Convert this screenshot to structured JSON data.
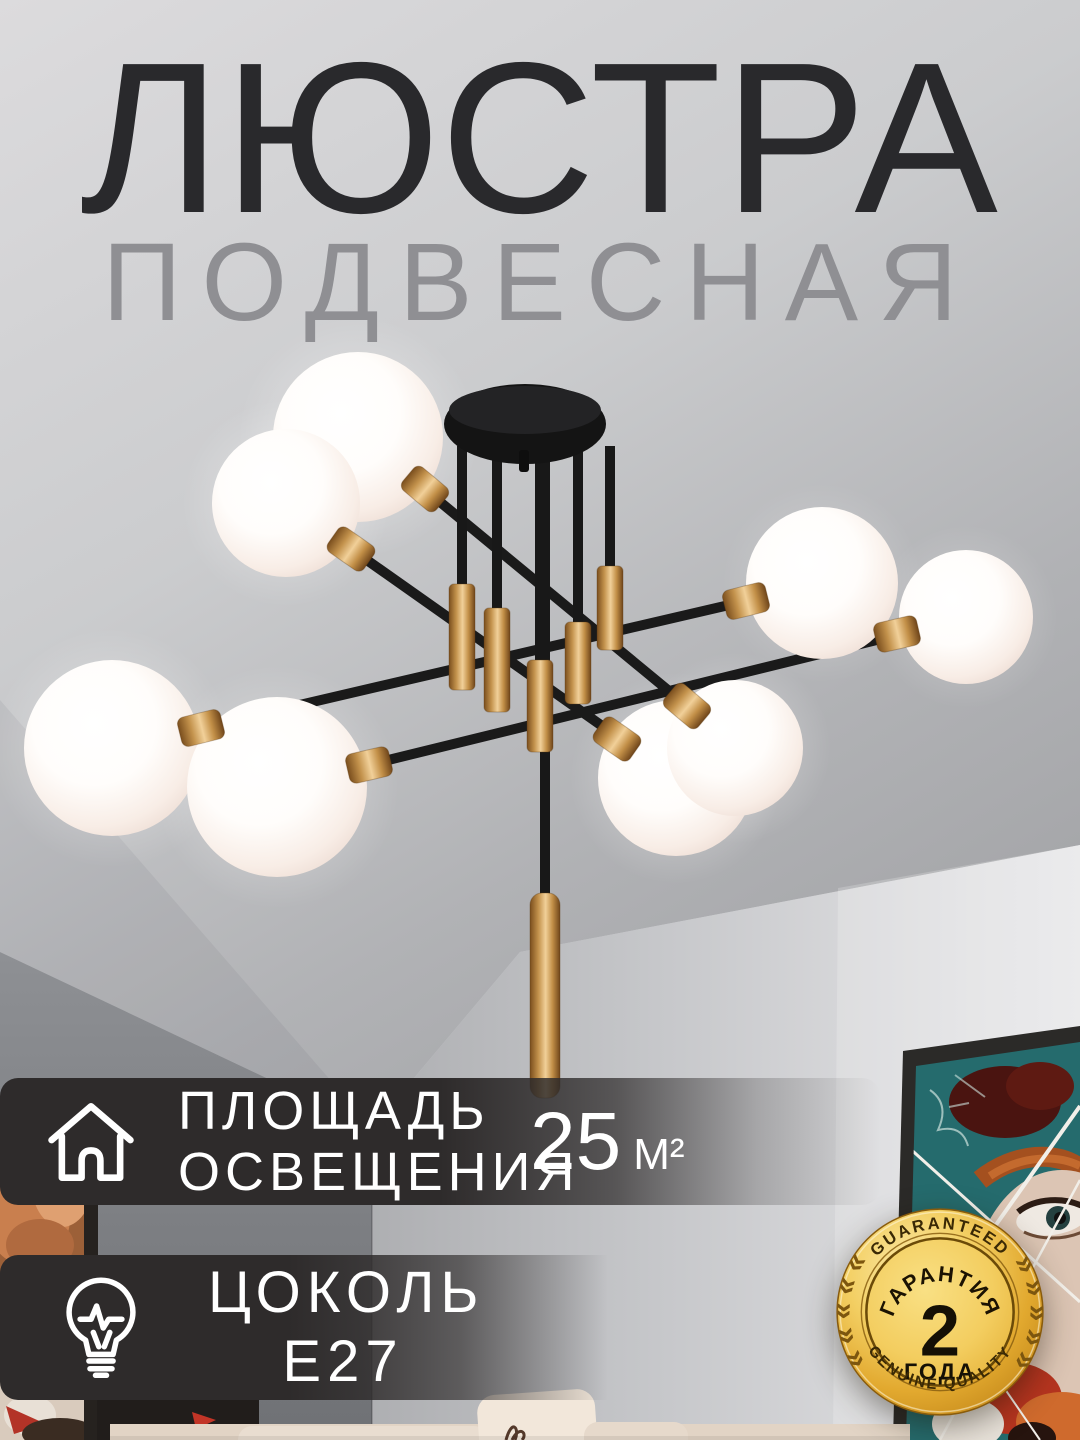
{
  "title": {
    "line1": "ЛЮСТРА",
    "line2": "ПОДВЕСНАЯ"
  },
  "features": [
    {
      "icon": "house-icon",
      "label_line1": "ПЛОЩАДЬ",
      "label_line2": "ОСВЕЩЕНИЯ",
      "value": "25",
      "unit": "М²"
    },
    {
      "icon": "bulb-icon",
      "label_line1": "ЦОКОЛЬ",
      "label_line2": "Е27"
    }
  ],
  "badge": {
    "arc_top": "GUARANTEED",
    "title": "ГАРАНТИЯ",
    "value": "2",
    "value_label": "ГОДА",
    "arc_bottom": "GENUINE QUALITY",
    "wreath_left": "««««««",
    "wreath_right": "»»»»»»"
  },
  "colors": {
    "banner_bg": "#2e2b2b",
    "title": "#29292c",
    "subtitle": "#8f8f93",
    "text_light": "#ffffff",
    "badge_gold": "#e9b845",
    "brass": "#c79a55",
    "globe": "#fdf7f2"
  }
}
